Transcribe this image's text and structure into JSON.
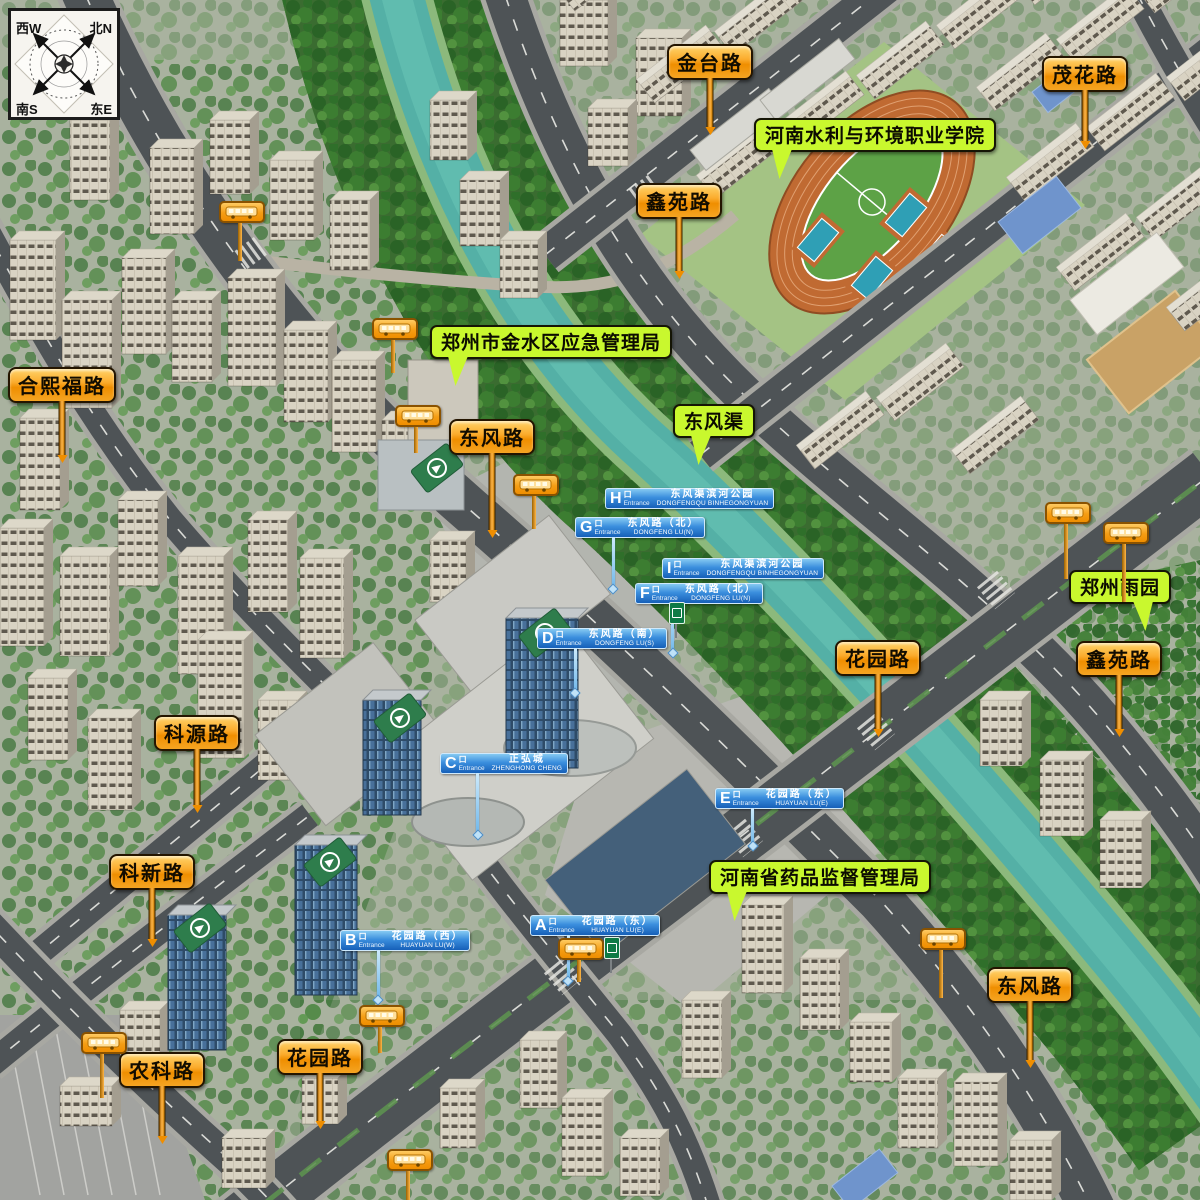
{
  "compass": {
    "corners": [
      {
        "pos": "nw",
        "label": "西W"
      },
      {
        "pos": "ne",
        "label": "北N"
      },
      {
        "pos": "sw",
        "label": "南S"
      },
      {
        "pos": "se",
        "label": "东E"
      }
    ]
  },
  "entrance_kou": "口",
  "entrance_word": "Entrance",
  "road_labels": [
    {
      "text": "金台路",
      "x": 710,
      "y": 62,
      "stem": 50
    },
    {
      "text": "茂花路",
      "x": 1085,
      "y": 74,
      "stem": 52
    },
    {
      "text": "鑫苑路",
      "x": 679,
      "y": 201,
      "stem": 55
    },
    {
      "text": "合熙福路",
      "x": 62,
      "y": 385,
      "stem": 55
    },
    {
      "text": "东风路",
      "x": 492,
      "y": 437,
      "stem": 78
    },
    {
      "text": "科源路",
      "x": 197,
      "y": 733,
      "stem": 57
    },
    {
      "text": "花园路",
      "x": 878,
      "y": 658,
      "stem": 56
    },
    {
      "text": "鑫苑路",
      "x": 1119,
      "y": 659,
      "stem": 55
    },
    {
      "text": "科新路",
      "x": 152,
      "y": 872,
      "stem": 52
    },
    {
      "text": "农科路",
      "x": 162,
      "y": 1070,
      "stem": 51
    },
    {
      "text": "花园路",
      "x": 320,
      "y": 1057,
      "stem": 49
    },
    {
      "text": "东风路",
      "x": 1030,
      "y": 985,
      "stem": 60
    }
  ],
  "facility_labels": [
    {
      "text": "河南水利与环境职业学院",
      "x": 875,
      "y": 135,
      "tip": "left"
    },
    {
      "text": "郑州市金水区应急管理局",
      "x": 551,
      "y": 342,
      "tip": "left"
    },
    {
      "text": "东风渠",
      "x": 714,
      "y": 421,
      "tip": "left"
    },
    {
      "text": "郑州雨园",
      "x": 1120,
      "y": 587,
      "tip": "right"
    },
    {
      "text": "河南省药品监督管理局",
      "x": 820,
      "y": 877,
      "tip": "left"
    }
  ],
  "entrances": [
    {
      "letter": "H",
      "cn": "东风渠滨河公园",
      "en": "DONGFENGQU BINHEGONGYUAN",
      "x": 605,
      "y": 488,
      "stem": 0
    },
    {
      "letter": "G",
      "cn": "东风路（北）",
      "en": "DONGFENG LU(N)",
      "x": 575,
      "y": 517,
      "stem": 52
    },
    {
      "letter": "I",
      "cn": "东风渠滨河公园",
      "en": "DONGFENGQU BINHEGONGYUAN",
      "x": 662,
      "y": 558,
      "stem": 0
    },
    {
      "letter": "F",
      "cn": "东风路（北）",
      "en": "DONGFENG LU(N)",
      "x": 635,
      "y": 583,
      "stem": 50
    },
    {
      "letter": "D",
      "cn": "东风路（南）",
      "en": "DONGFENG LU(S)",
      "x": 537,
      "y": 628,
      "stem": 45
    },
    {
      "letter": "C",
      "cn": "正弘城",
      "en": "ZHENGHONG CHENG",
      "x": 440,
      "y": 753,
      "stem": 62
    },
    {
      "letter": "E",
      "cn": "花园路（东）",
      "en": "HUAYUAN LU(E)",
      "x": 715,
      "y": 788,
      "stem": 38
    },
    {
      "letter": "B",
      "cn": "花园路（西）",
      "en": "HUAYUAN LU(W)",
      "x": 340,
      "y": 930,
      "stem": 50
    },
    {
      "letter": "A",
      "cn": "花园路（东）",
      "en": "HUAYUAN LU(E)",
      "x": 530,
      "y": 915,
      "stem": 46
    }
  ],
  "bus_stops": [
    [
      240,
      210,
      38
    ],
    [
      393,
      327,
      33
    ],
    [
      416,
      414,
      26
    ],
    [
      534,
      483,
      33
    ],
    [
      1066,
      511,
      55
    ],
    [
      1124,
      531,
      58
    ],
    [
      941,
      937,
      48
    ],
    [
      102,
      1041,
      44
    ],
    [
      380,
      1014,
      26
    ],
    [
      579,
      947,
      22
    ],
    [
      408,
      1158,
      38
    ]
  ],
  "metro_signs": [
    [
      676,
      612
    ],
    [
      611,
      947
    ]
  ],
  "colors": {
    "label_orange": "#f29500",
    "label_green": "#c9f82e",
    "entrance_blue": "#2f86d6",
    "river_teal": "#54b0a6"
  }
}
